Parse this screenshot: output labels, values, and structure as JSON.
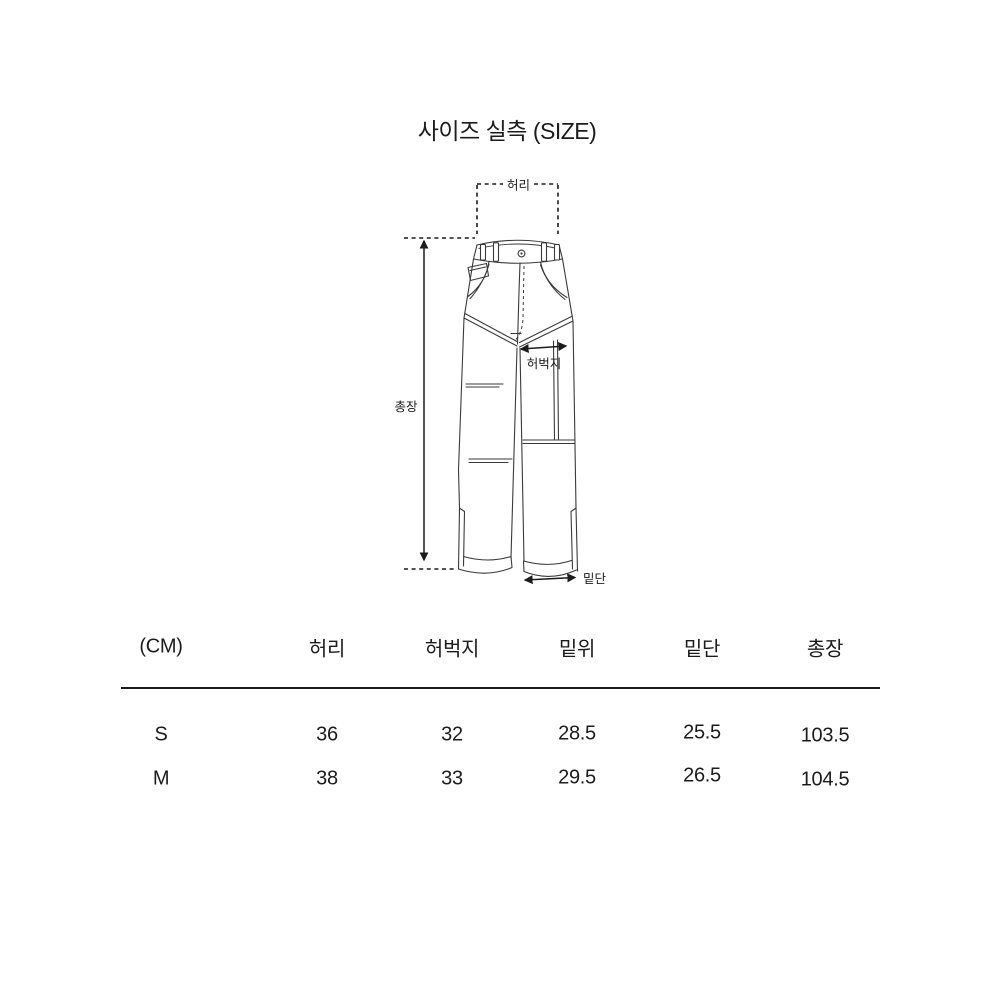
{
  "page": {
    "title": "사이즈 실측 (SIZE)"
  },
  "diagram": {
    "labels": {
      "waist": "허리",
      "total_length": "총장",
      "thigh": "허벅지",
      "hem": "밑단"
    }
  },
  "table": {
    "header": [
      "(CM)",
      "허리",
      "허벅지",
      "밑위",
      "밑단",
      "총장"
    ],
    "rows": [
      [
        "S",
        "36",
        "32",
        "28.5",
        "25.5",
        "103.5"
      ],
      [
        "M",
        "38",
        "33",
        "29.5",
        "26.5",
        "104.5"
      ]
    ]
  },
  "colors": {
    "ink": "#1c1c1c",
    "line": "#3a3a3a",
    "bg": "#ffffff"
  }
}
